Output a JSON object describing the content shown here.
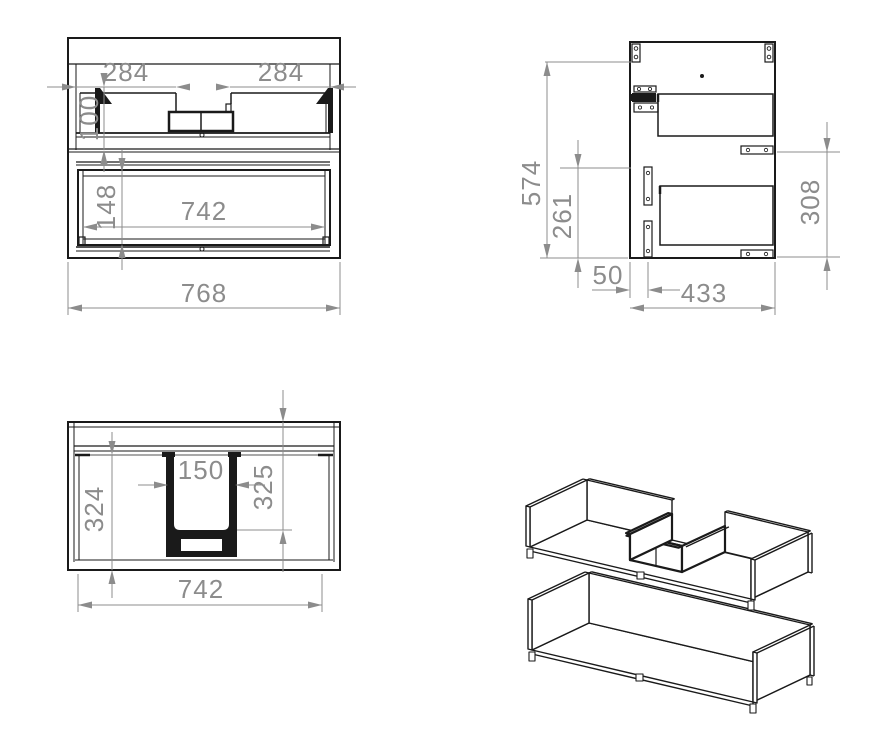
{
  "drawing": {
    "description": "Technical drawing of vanity cabinet drawer unit, four views",
    "front_view": {
      "dim_left_top": "284",
      "dim_right_top": "284",
      "dim_upper_drawer_height": "100",
      "dim_lower_drawer_height": "148",
      "dim_inner_width": "742",
      "dim_overall_width": "768"
    },
    "side_view": {
      "dim_overall_height": "574",
      "dim_lower_height": "261",
      "dim_rail_span": "308",
      "dim_back_offset": "50",
      "dim_depth": "433"
    },
    "top_view": {
      "dim_cutout_width": "150",
      "dim_cutout_depth": "325",
      "dim_inner_depth": "324",
      "dim_inner_width": "742"
    },
    "isometric_view": {
      "label": "exploded drawer boxes"
    },
    "colors": {
      "line": "#1a1a1a",
      "dimension": "#8c8c8c",
      "background": "#ffffff"
    }
  }
}
